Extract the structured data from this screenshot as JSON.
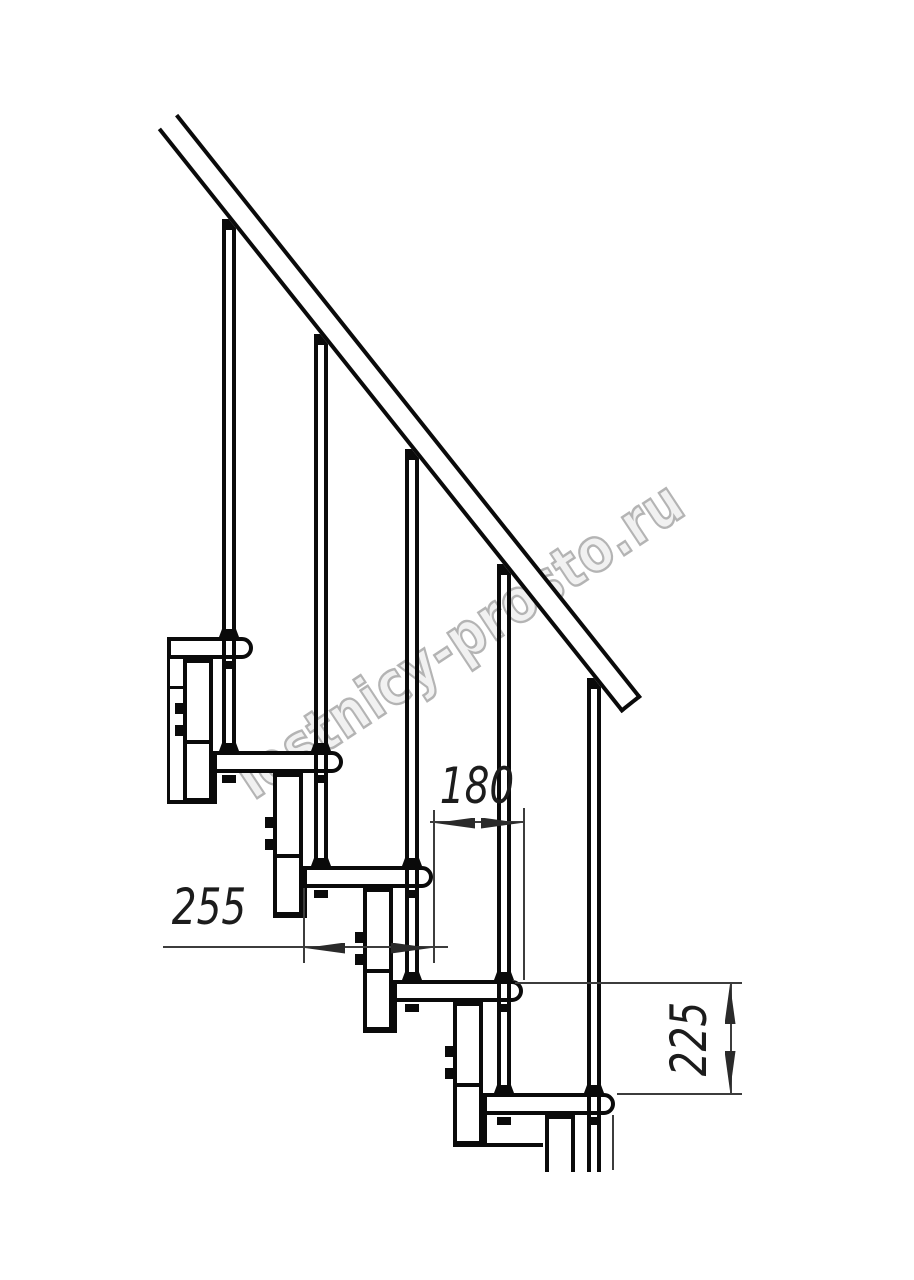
{
  "title": "Modular staircase section drawing",
  "watermark": {
    "text": "lestnicy-prosto.ru",
    "color": "#b4b4b4",
    "x": 460,
    "y": 640,
    "rotation": -33.5,
    "scale_x": 0.84
  },
  "colors": {
    "line": "#0a0a0a",
    "dim_line": "#3c3c3c",
    "background": "#ffffff"
  },
  "dimensions": [
    {
      "value": "180",
      "x": 477,
      "y": 786,
      "rotation": 0
    },
    {
      "value": "255",
      "x": 209,
      "y": 907,
      "rotation": 0
    },
    {
      "value": "225",
      "x": 689,
      "y": 1039,
      "rotation": -90
    }
  ],
  "drawing": {
    "treads": [
      {
        "x": 167,
        "y": 637,
        "w": 86,
        "h": 22
      },
      {
        "x": 213,
        "y": 751,
        "w": 130,
        "h": 22
      },
      {
        "x": 303,
        "y": 866,
        "w": 130,
        "h": 22
      },
      {
        "x": 393,
        "y": 980,
        "w": 130,
        "h": 22
      },
      {
        "x": 483,
        "y": 1093,
        "w": 132,
        "h": 22
      }
    ],
    "modules": [
      {
        "x": 183,
        "y": 659,
        "w": 30,
        "h": 143,
        "cut": false
      },
      {
        "x": 273,
        "y": 773,
        "w": 30,
        "h": 143,
        "cut": false
      },
      {
        "x": 363,
        "y": 888,
        "w": 30,
        "h": 143,
        "cut": false
      },
      {
        "x": 453,
        "y": 1002,
        "w": 30,
        "h": 143,
        "cut": false
      },
      {
        "x": 545,
        "y": 1115,
        "w": 30,
        "h": 57,
        "cut": true
      }
    ],
    "struct_lines": [
      {
        "o": "h",
        "x": 183,
        "y": 740,
        "len": 30,
        "t": 4
      },
      {
        "o": "h",
        "x": 273,
        "y": 854,
        "len": 30,
        "t": 4
      },
      {
        "o": "h",
        "x": 363,
        "y": 969,
        "len": 30,
        "t": 4
      },
      {
        "o": "h",
        "x": 453,
        "y": 1083,
        "len": 30,
        "t": 4
      },
      {
        "o": "h",
        "x": 167,
        "y": 800,
        "len": 46,
        "t": 4
      },
      {
        "o": "h",
        "x": 273,
        "y": 914,
        "len": 33,
        "t": 4
      },
      {
        "o": "h",
        "x": 363,
        "y": 1029,
        "len": 33,
        "t": 4
      },
      {
        "o": "h",
        "x": 453,
        "y": 1143,
        "len": 90,
        "t": 4
      },
      {
        "o": "v",
        "x": 213,
        "y": 773,
        "len": 31,
        "t": 4
      },
      {
        "o": "v",
        "x": 303,
        "y": 888,
        "len": 30,
        "t": 4
      },
      {
        "o": "v",
        "x": 393,
        "y": 1002,
        "len": 31,
        "t": 4
      },
      {
        "o": "v",
        "x": 483,
        "y": 1115,
        "len": 32,
        "t": 4
      },
      {
        "o": "v",
        "x": 167,
        "y": 659,
        "len": 145,
        "t": 3
      },
      {
        "o": "h",
        "x": 167,
        "y": 686,
        "len": 16,
        "t": 3
      }
    ],
    "balusters": [
      {
        "x": 222,
        "cap_y": 219,
        "top": 230,
        "bottom": 745
      },
      {
        "x": 314,
        "cap_y": 334,
        "top": 345,
        "bottom": 860
      },
      {
        "x": 405,
        "cap_y": 449,
        "top": 460,
        "bottom": 974
      },
      {
        "x": 497,
        "cap_y": 564,
        "top": 575,
        "bottom": 1087
      },
      {
        "x": 587,
        "cap_y": 678,
        "top": 689,
        "bottom": 1172
      }
    ],
    "feet": [
      {
        "x": 219,
        "y": 629
      },
      {
        "x": 219,
        "y": 743
      },
      {
        "x": 311,
        "y": 743
      },
      {
        "x": 311,
        "y": 858
      },
      {
        "x": 402,
        "y": 858
      },
      {
        "x": 402,
        "y": 972
      },
      {
        "x": 494,
        "y": 972
      },
      {
        "x": 494,
        "y": 1085
      },
      {
        "x": 584,
        "y": 1085
      }
    ],
    "nuts": [
      {
        "x": 222,
        "y": 661
      },
      {
        "x": 222,
        "y": 775
      },
      {
        "x": 314,
        "y": 775
      },
      {
        "x": 314,
        "y": 890
      },
      {
        "x": 405,
        "y": 890
      },
      {
        "x": 405,
        "y": 1004
      },
      {
        "x": 497,
        "y": 1004
      },
      {
        "x": 497,
        "y": 1117
      },
      {
        "x": 587,
        "y": 1117
      }
    ],
    "module_bolts": [
      {
        "x": 175,
        "y": 703
      },
      {
        "x": 175,
        "y": 725
      },
      {
        "x": 265,
        "y": 817
      },
      {
        "x": 265,
        "y": 839
      },
      {
        "x": 355,
        "y": 932
      },
      {
        "x": 355,
        "y": 954
      },
      {
        "x": 445,
        "y": 1046
      },
      {
        "x": 445,
        "y": 1068
      }
    ],
    "rail": {
      "x": 168,
      "y": 122,
      "length": 745,
      "thickness": 26,
      "angle": 51.5
    },
    "dim_lines": [
      {
        "o": "v",
        "x": 303,
        "y": 888,
        "len": 75
      },
      {
        "o": "v",
        "x": 433,
        "y": 810,
        "len": 153
      },
      {
        "o": "v",
        "x": 523,
        "y": 808,
        "len": 172
      },
      {
        "o": "v",
        "x": 612,
        "y": 1115,
        "len": 55
      },
      {
        "o": "v",
        "x": 730,
        "y": 982,
        "len": 111
      },
      {
        "o": "h",
        "x": 515,
        "y": 982,
        "len": 227
      },
      {
        "o": "h",
        "x": 617,
        "y": 1093,
        "len": 125
      },
      {
        "o": "h",
        "x": 163,
        "y": 946,
        "len": 285
      },
      {
        "o": "h",
        "x": 430,
        "y": 821,
        "len": 95
      }
    ],
    "arrows": [
      {
        "x": 305,
        "y": 948,
        "dir": "left"
      },
      {
        "x": 431,
        "y": 948,
        "dir": "right"
      },
      {
        "x": 435,
        "y": 823,
        "dir": "left"
      },
      {
        "x": 521,
        "y": 823,
        "dir": "right"
      },
      {
        "x": 730,
        "y": 984,
        "dir": "up"
      },
      {
        "x": 730,
        "y": 1091,
        "dir": "down"
      }
    ]
  }
}
